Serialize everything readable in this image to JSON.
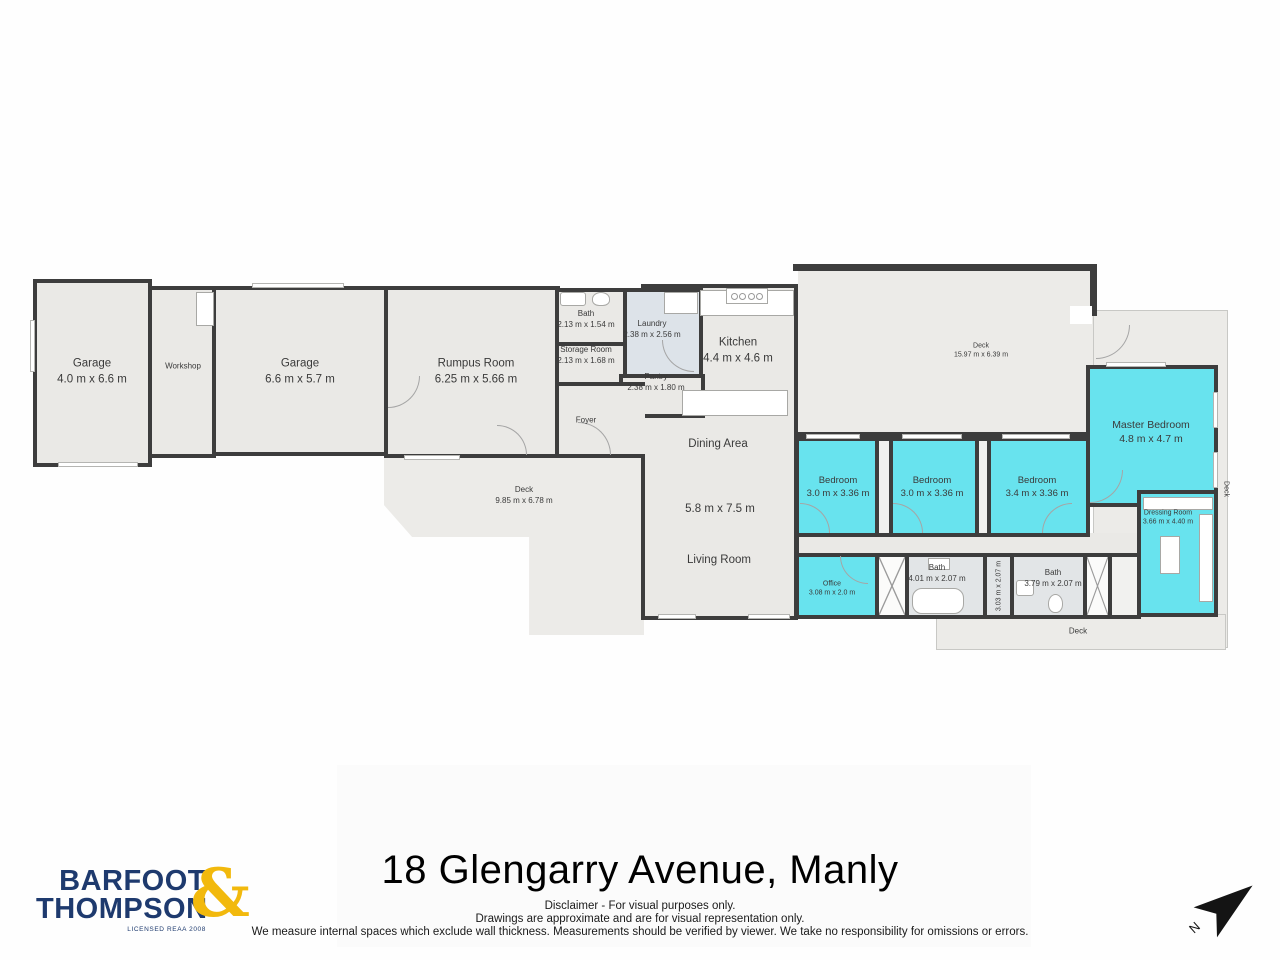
{
  "title": "18 Glengarry Avenue, Manly",
  "disclaimer": {
    "line1": "Disclaimer - For visual purposes only.",
    "line2": "Drawings are approximate and are for visual representation only.",
    "line3": "We measure internal spaces which exclude wall thickness. Measurements should be verified by viewer. We take no responsibility for omissions or errors."
  },
  "logo": {
    "line1": "BARFOOT",
    "line2": "THOMPSON",
    "ampersand": "&",
    "tagline": "LICENSED REAA 2008",
    "navy": "#1e3a6e",
    "gold": "#f2b90d"
  },
  "compass": {
    "label": "N"
  },
  "colors": {
    "wall": "#3d3d3d",
    "floor": "#eae9e6",
    "highlight_cyan": "#68e3ee",
    "deck": "#ecebe8"
  },
  "rooms": {
    "garage1": {
      "name": "Garage",
      "dims": "4.0 m x 6.6 m"
    },
    "workshop": {
      "name": "Workshop"
    },
    "garage2": {
      "name": "Garage",
      "dims": "6.6 m x 5.7 m"
    },
    "rumpus": {
      "name": "Rumpus Room",
      "dims": "6.25 m x 5.66 m"
    },
    "bath1": {
      "name": "Bath",
      "dims": "2.13 m x 1.54 m"
    },
    "storage": {
      "name": "Storage Room",
      "dims": "2.13 m x 1.68 m"
    },
    "laundry": {
      "name": "Laundry",
      "dims": "2.38 m x 2.56 m"
    },
    "pantry": {
      "name": "Pantry",
      "dims": "2.38 m x 1.80 m"
    },
    "foyer": {
      "name": "Foyer"
    },
    "kitchen": {
      "name": "Kitchen",
      "dims": "4.4 m x 4.6 m"
    },
    "dining": {
      "name": "Dining Area"
    },
    "living": {
      "name": "Living Room",
      "dims": "5.8 m x 7.5 m"
    },
    "deck_top": {
      "name": "Deck",
      "dims": "15.97 m x 6.39 m"
    },
    "deck_left": {
      "name": "Deck",
      "dims": "9.85 m x 6.78 m"
    },
    "bedroom1": {
      "name": "Bedroom",
      "dims": "3.0 m x 3.36 m"
    },
    "bedroom2": {
      "name": "Bedroom",
      "dims": "3.0 m x 3.36 m"
    },
    "bedroom3": {
      "name": "Bedroom",
      "dims": "3.4 m x 3.36 m"
    },
    "master": {
      "name": "Master Bedroom",
      "dims": "4.8 m x 4.7 m"
    },
    "dressing": {
      "name": "Dressing Room",
      "dims": "3.66 m x 4.40 m"
    },
    "office": {
      "name": "Office",
      "dims": "3.08 m x 2.0 m"
    },
    "bath2": {
      "name": "Bath",
      "dims": "4.01 m x 2.07 m"
    },
    "hallway": {
      "dims": "3.03 m x 2.07 m"
    },
    "bath3": {
      "name": "Bath",
      "dims": "3.79 m x 2.07 m"
    },
    "deck_bottom": {
      "name": "Deck"
    },
    "deck_right": {
      "name": "Deck"
    }
  }
}
